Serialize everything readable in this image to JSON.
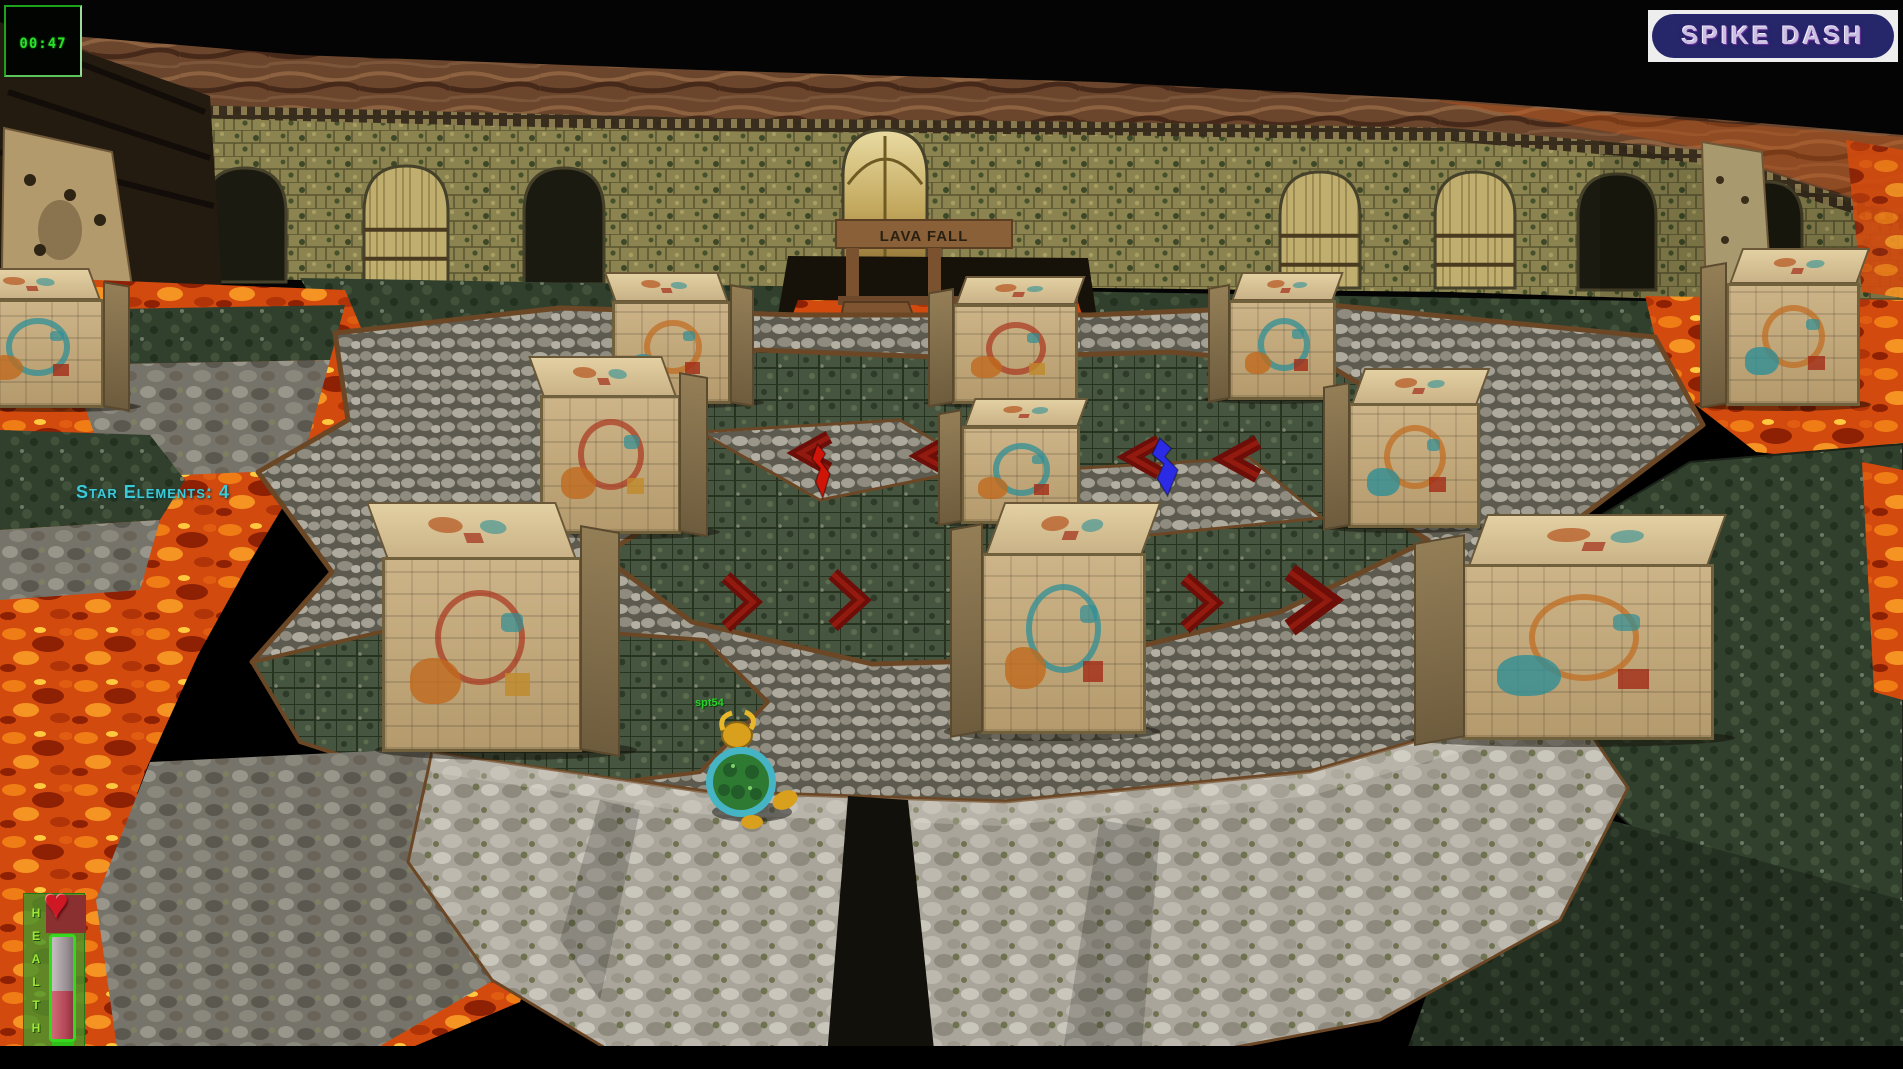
{
  "hud": {
    "timer": "00:47",
    "logo": "SPIKE DASH",
    "star_elements_label": "Star Elements: 4",
    "health_label": "HEALTH",
    "player_label": "spt54"
  },
  "scene": {
    "gate_sign": "LAVA FALL",
    "colors": {
      "timer_green": "#2be22b",
      "star_text_cyan": "#3ec9d6",
      "logo_pill_blue": "#26266a",
      "logo_frame_white": "#eeeeee",
      "health_fill_red": "#b04452",
      "health_frame_green": "#35d81c",
      "lava_orange": "#d24a0e",
      "wall_olive": "#8b8350",
      "moss_green": "#465540",
      "cobble_grey": "#9a978c",
      "block_stone": "#c9b07f",
      "arrow_dark_red": "#6e0e08",
      "spike_red": "#cf1408",
      "spike_blue": "#2b2be6",
      "turtle_shell_green": "#2f7a33",
      "turtle_rim_teal": "#45b5c5",
      "turtle_yellow": "#d8a01c"
    },
    "arches": [
      {
        "x": 204,
        "w": 82,
        "y1": 168,
        "y2": 282,
        "type": "dark"
      },
      {
        "x": 364,
        "w": 84,
        "y1": 166,
        "y2": 282,
        "type": "wood"
      },
      {
        "x": 524,
        "w": 80,
        "y1": 168,
        "y2": 284,
        "type": "dark"
      },
      {
        "x": 843,
        "w": 84,
        "y1": 130,
        "y2": 262,
        "type": "gold"
      },
      {
        "x": 1280,
        "w": 80,
        "y1": 172,
        "y2": 288,
        "type": "wood"
      },
      {
        "x": 1435,
        "w": 80,
        "y1": 172,
        "y2": 288,
        "type": "wood"
      },
      {
        "x": 1578,
        "w": 78,
        "y1": 174,
        "y2": 290,
        "type": "dark"
      },
      {
        "x": 1732,
        "w": 70,
        "y1": 182,
        "y2": 298,
        "type": "dark"
      }
    ],
    "blocks": [
      {
        "x": -30,
        "y": 268,
        "w": 160,
        "h": 140,
        "side": "right"
      },
      {
        "x": 612,
        "y": 272,
        "w": 142,
        "h": 132,
        "side": "right"
      },
      {
        "x": 928,
        "y": 276,
        "w": 150,
        "h": 128,
        "side": "left"
      },
      {
        "x": 1208,
        "y": 272,
        "w": 128,
        "h": 128,
        "side": "left"
      },
      {
        "x": 1700,
        "y": 248,
        "w": 160,
        "h": 158,
        "side": "left"
      },
      {
        "x": 540,
        "y": 356,
        "w": 168,
        "h": 178,
        "side": "right"
      },
      {
        "x": 938,
        "y": 398,
        "w": 142,
        "h": 126,
        "side": "left"
      },
      {
        "x": 1323,
        "y": 368,
        "w": 157,
        "h": 160,
        "side": "left"
      },
      {
        "x": 382,
        "y": 502,
        "w": 238,
        "h": 250,
        "side": "right"
      },
      {
        "x": 950,
        "y": 502,
        "w": 196,
        "h": 232,
        "side": "left"
      },
      {
        "x": 1414,
        "y": 514,
        "w": 300,
        "h": 226,
        "side": "left"
      }
    ],
    "chevrons": [
      {
        "x": 783,
        "y": 437,
        "w": 46,
        "h": 32,
        "dir": "left"
      },
      {
        "x": 905,
        "y": 440,
        "w": 46,
        "h": 32,
        "dir": "left"
      },
      {
        "x": 1113,
        "y": 441,
        "w": 46,
        "h": 32,
        "dir": "left"
      },
      {
        "x": 1208,
        "y": 442,
        "w": 50,
        "h": 34,
        "dir": "left"
      },
      {
        "x": 726,
        "y": 577,
        "w": 44,
        "h": 50,
        "dir": "right"
      },
      {
        "x": 833,
        "y": 574,
        "w": 46,
        "h": 52,
        "dir": "right"
      },
      {
        "x": 1185,
        "y": 578,
        "w": 46,
        "h": 50,
        "dir": "right"
      },
      {
        "x": 1290,
        "y": 572,
        "w": 62,
        "h": 56,
        "dir": "right"
      }
    ],
    "spikes": [
      {
        "x": 812,
        "y": 444,
        "w": 18,
        "h": 54,
        "color": "#cf1408",
        "kind": "red-spike"
      },
      {
        "x": 1152,
        "y": 438,
        "w": 26,
        "h": 58,
        "color": "#2b2be6",
        "kind": "blue-spike"
      }
    ]
  }
}
